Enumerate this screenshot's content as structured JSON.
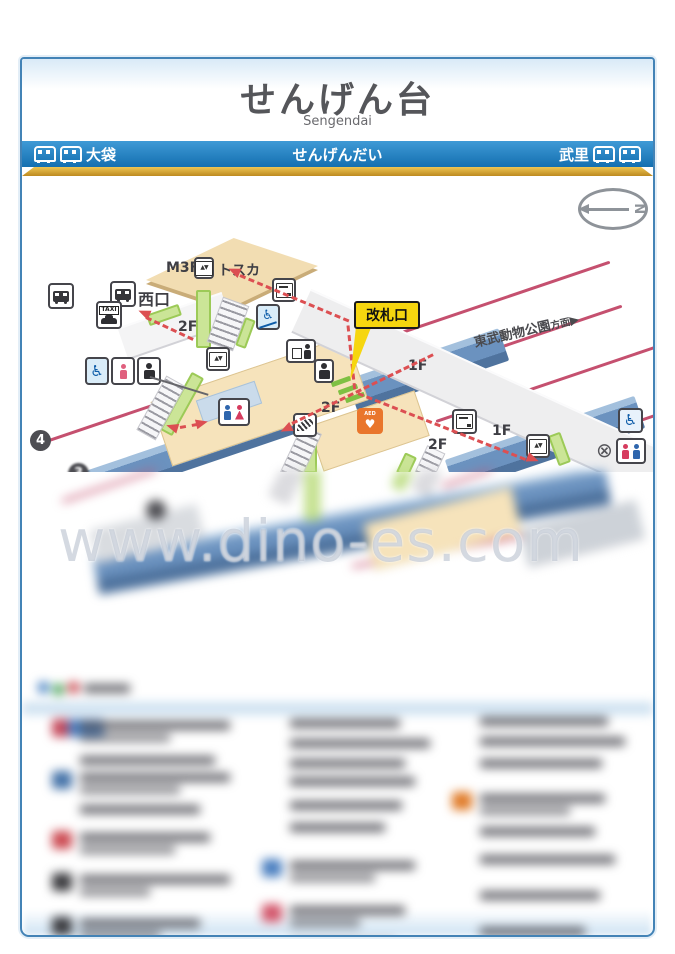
{
  "watermark": "www.dino-es.com",
  "header": {
    "title": "せんげん台",
    "romaji": "Sengendai"
  },
  "navbar": {
    "left_station": "大袋",
    "center_station": "せんげんだい",
    "right_station": "武里"
  },
  "map": {
    "compass_n": "N",
    "m3f": "M3F",
    "tosca": "トスカ",
    "west_exit": "西口",
    "taxi": "TAXI",
    "gate": "改札口",
    "f1": "1F",
    "f2": "2F",
    "direction": "東武動物公園",
    "direction_suffix": "方面",
    "direction_arrow": "▶",
    "platform_4": "4",
    "platform_3": "3",
    "aed": "AED"
  },
  "icons": {
    "wheelchair": "♿",
    "closed": "⊗",
    "elevator_arrows": "▲▼",
    "heart": "♥"
  }
}
